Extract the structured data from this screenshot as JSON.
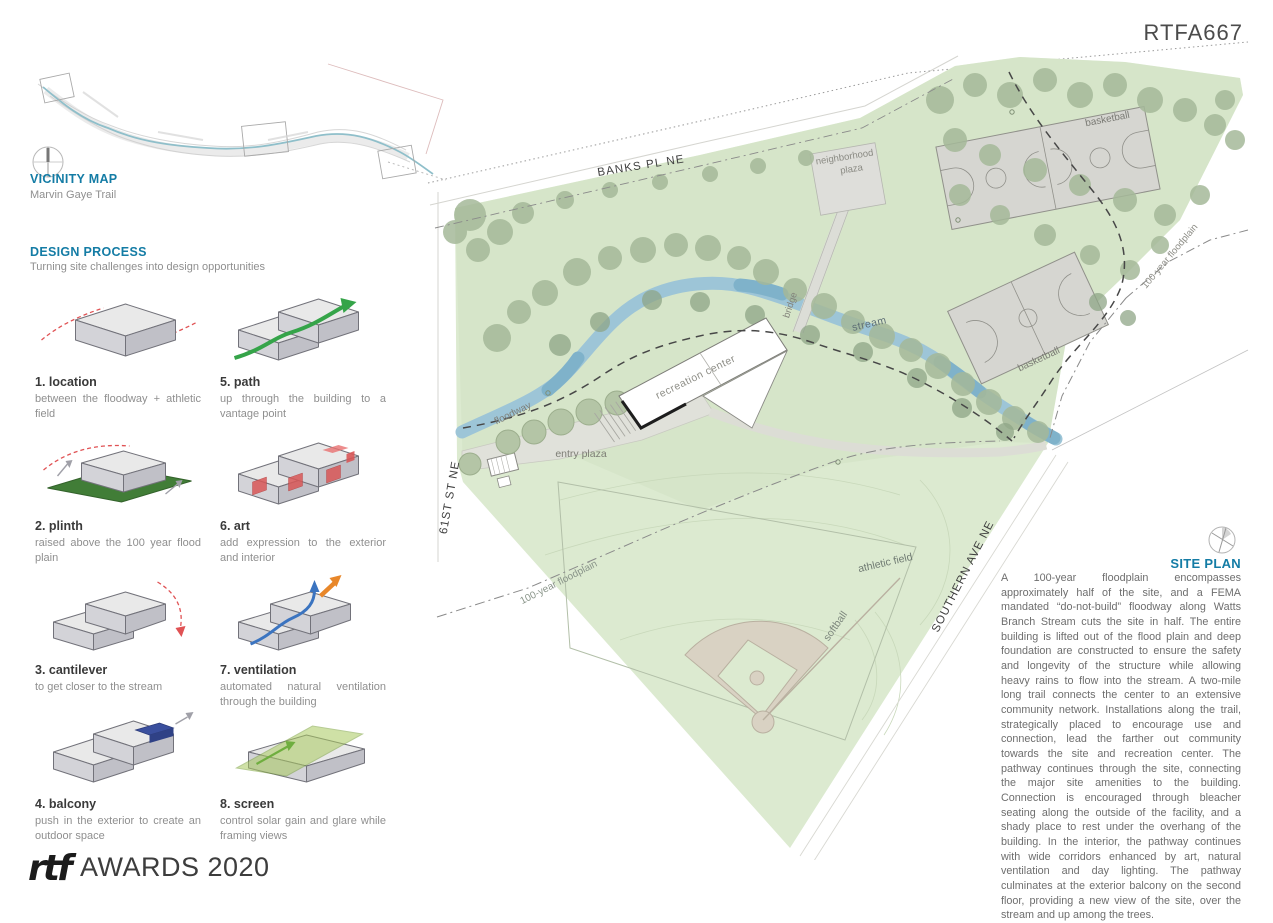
{
  "board": {
    "code": "RTFA667"
  },
  "vicinity": {
    "heading": "VICINITY MAP",
    "subtitle": "Marvin Gaye Trail"
  },
  "design_process": {
    "heading": "DESIGN PROCESS",
    "subtitle": "Turning site challenges into design opportunities",
    "steps": [
      {
        "title": "1. location",
        "desc": "between the floodway + athletic field"
      },
      {
        "title": "5. path",
        "desc": "up through the building to a vantage point"
      },
      {
        "title": "2. plinth",
        "desc": "raised above the 100 year flood plain"
      },
      {
        "title": "6. art",
        "desc": "add expression to the exterior and interior"
      },
      {
        "title": "3. cantilever",
        "desc": "to get closer to the stream"
      },
      {
        "title": "7. ventilation",
        "desc": "automated natural ventilation through the building"
      },
      {
        "title": "4. balcony",
        "desc": "push in the exterior to create an outdoor space"
      },
      {
        "title": "8. screen",
        "desc": "control solar gain and glare while framing views"
      }
    ]
  },
  "site_plan": {
    "heading": "SITE PLAN",
    "description": "A 100-year floodplain encompasses approximately half of the site, and a FEMA mandated “do-not-build” floodway along Watts Branch Stream cuts the site in half. The entire building is lifted out of the flood plain and deep foundation are constructed to ensure the safety and longevity of the structure while allowing heavy rains to flow into the stream. A two-mile long trail connects the center to an extensive community network. Installations along the trail, strategically placed to encourage use and connection, lead the farther out community towards the site and recreation center. The pathway continues through the site, connecting the major site amenities to the building. Connection is encouraged through bleacher seating along the outside of the facility, and a shady place to rest under the overhang of the building. In the interior, the pathway continues with wide corridors enhanced by art, natural ventilation and day lighting. The pathway culminates at the exterior balcony on the second floor, providing a new view of the site, over the stream and up among the trees.",
    "labels": {
      "banks_pl": "BANKS PL NE",
      "neighborhood_1": "neighborhood",
      "neighborhood_2": "plaza",
      "basketball_top": "basketball",
      "floodplain_ne": "100-year floodplain",
      "bridge": "bridge",
      "stream": "stream",
      "basketball_mid": "basketball",
      "recreation_center": "recreation center",
      "floodway": "floodway",
      "entry_plaza": "entry plaza",
      "street_61": "61ST ST NE",
      "floodplain_sw": "100-year floodplain",
      "athletic_field": "athletic field",
      "softball": "softball",
      "southern_ave": "SOUTHERN AVE NE"
    }
  },
  "footer": {
    "logo": "rtf",
    "text": "AWARDS 2020"
  },
  "icons": {
    "compass": "circle-crosshair"
  },
  "colors": {
    "accent_teal": "#147ca5",
    "site_green": "#dcead0",
    "stream_blue": "#9dc5d7",
    "tree_green": "#a5b999",
    "red_dash": "#e05254"
  }
}
